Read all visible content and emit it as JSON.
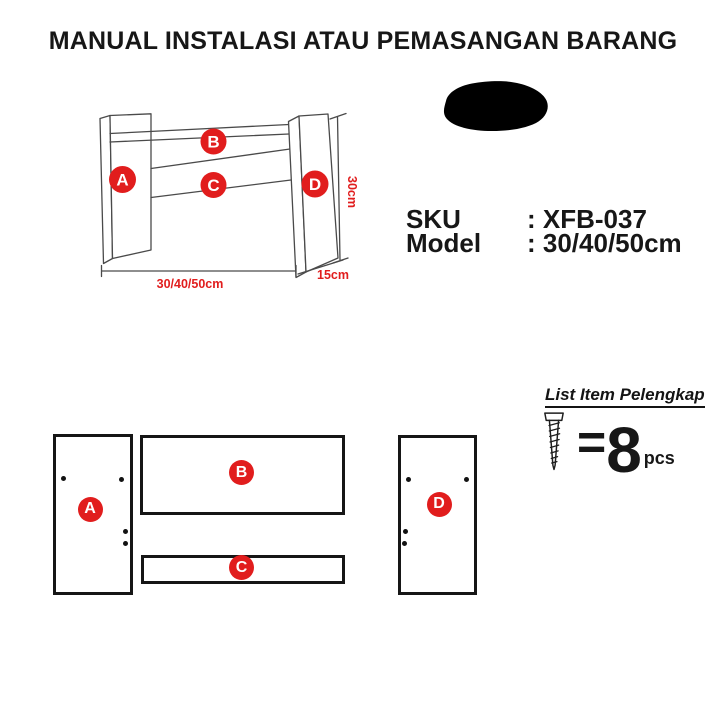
{
  "title": "MANUAL INSTALASI ATAU PEMASANGAN BARANG",
  "colors": {
    "red": "#e11d1d",
    "line": "#4a4a4a",
    "ink": "#161616"
  },
  "diagram": {
    "part_labels": {
      "a": "A",
      "b": "B",
      "c": "C",
      "d": "D"
    },
    "dim_height": "30cm",
    "dim_width": "30/40/50cm",
    "dim_depth": "15cm"
  },
  "product": {
    "sku_label": "SKU",
    "sku_value": ": XFB-037",
    "model_label": "Model",
    "model_value": ": 30/40/50cm"
  },
  "hardware": {
    "heading": "List Item Pelengkap",
    "equals": "=",
    "count": "8",
    "unit": "pcs",
    "screw_icon": "screw-icon"
  }
}
